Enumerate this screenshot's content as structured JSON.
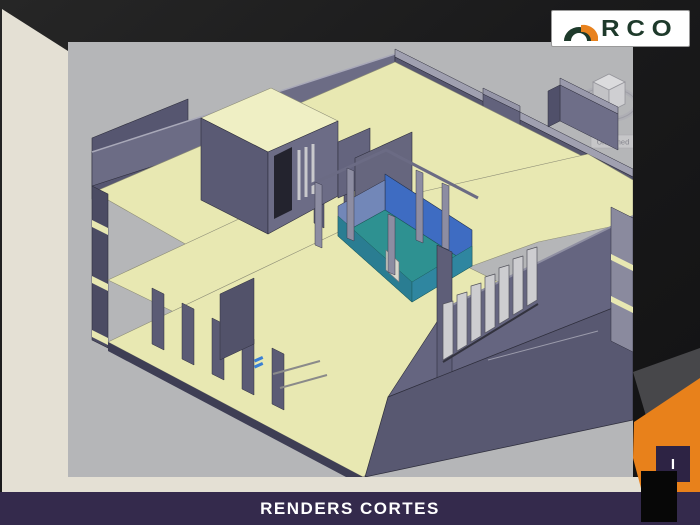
{
  "brand": {
    "name": "ARCO",
    "letters": "RCO",
    "arch_icon": "arch-icon",
    "green": "#1e3a2b",
    "orange": "#e8821e"
  },
  "viewer": {
    "viewcube": {
      "compass_label": "S",
      "view_name": "Unnamed"
    },
    "model_description": "isometric-section-render-of-building"
  },
  "footer": {
    "title": "RENDERS CORTES"
  },
  "page_marker": {
    "label": "I"
  },
  "palette": {
    "accent_orange": "#E8811B",
    "banner_purple": "#342A4C",
    "canvas_gray": "#B5B6B8",
    "model_cream": "#E8E8B2",
    "wall_gray": "#5A5A73",
    "courtyard_teal": "#2E9191",
    "courtyard_blue": "#3E6CC2",
    "band_cream": "#E4E0D4"
  }
}
